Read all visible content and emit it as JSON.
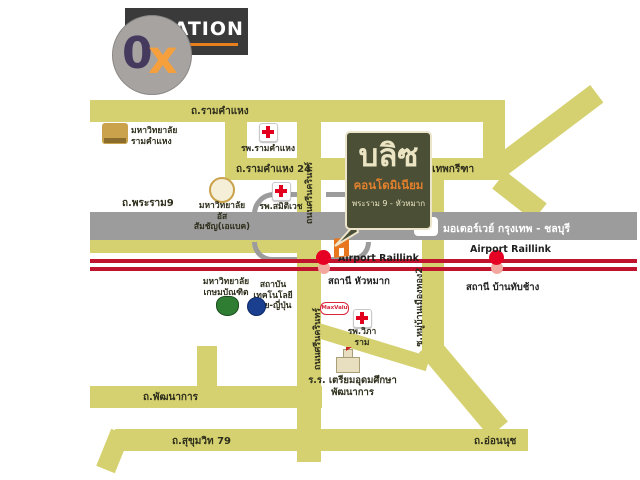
{
  "logo": {
    "title": "LOCATION"
  },
  "watermark": {
    "zero": "0",
    "x": "x"
  },
  "project": {
    "name": "บลิซ",
    "type": "คอนโดมิเนียม",
    "location": "พระราม 9 - หัวหมาก"
  },
  "motorway": {
    "label": "มอเตอร์เวย์ กรุงเทพ - ชลบุรี",
    "uturn_icon": "↩"
  },
  "railway": {
    "huamak": {
      "line": "Airport Raillink",
      "station": "สถานี หัวหมาก"
    },
    "banthapchang": {
      "line": "Airport Raillink",
      "station": "สถานี บ้านทับช้าง"
    }
  },
  "roads": {
    "ramkhamhaeng": "ถ.รามคำแหง",
    "ramkhamhaeng24": "ถ.รามคำแหง 24",
    "rama9": "ถ.พระราม9",
    "krungthep_kreetha": "ถ.กรุงเทพกรีฑา",
    "srinagarindra_upper": "ถนนศรีนครินทร์",
    "srinagarindra_lower": "ถนนศรีนครินทร์",
    "muban_muangthong2": "ซ.หมู่บ้านเมืองทอง2",
    "phatthanakan": "ถ.พัฒนาการ",
    "sukhumvit79": "ถ.สุขุมวิท 79",
    "onnut": "ถ.อ่อนนุช"
  },
  "places": {
    "ramkhamhaeng_university": {
      "line1": "มหาวิทยาลัย",
      "line2": "รามคำแหง"
    },
    "ramkhamhaeng_hospital": {
      "label": "รพ.รามคำแหง"
    },
    "abac_university": {
      "line1": "มหาวิทยาลัย",
      "line2": "อัสสัมชัญ(เอแบค)"
    },
    "samitivej_hospital": {
      "label": "รพ.สมิติเวช"
    },
    "kasem_bundit_university": {
      "line1": "มหาวิทยาลัย",
      "line2": "เกษมบัณฑิต"
    },
    "thai_nichi_institute": {
      "line1": "สถาบันเทคโนโลยี",
      "line2": "ไทย-ญี่ปุ่น"
    },
    "vibharam_hospital": {
      "label": "รพ.วิภาราม"
    },
    "maxvalu": {
      "label": "MaxValu"
    },
    "triamudom_school": {
      "line1": "ร.ร. เตรียมอุดมศึกษา",
      "line2": "พัฒนาการ"
    }
  },
  "colors": {
    "road": "#d5d170",
    "motorway": "#9c9c9c",
    "railway": "#c0132e",
    "project_bg": "#4a4f35",
    "accent_orange": "#e8761e"
  }
}
